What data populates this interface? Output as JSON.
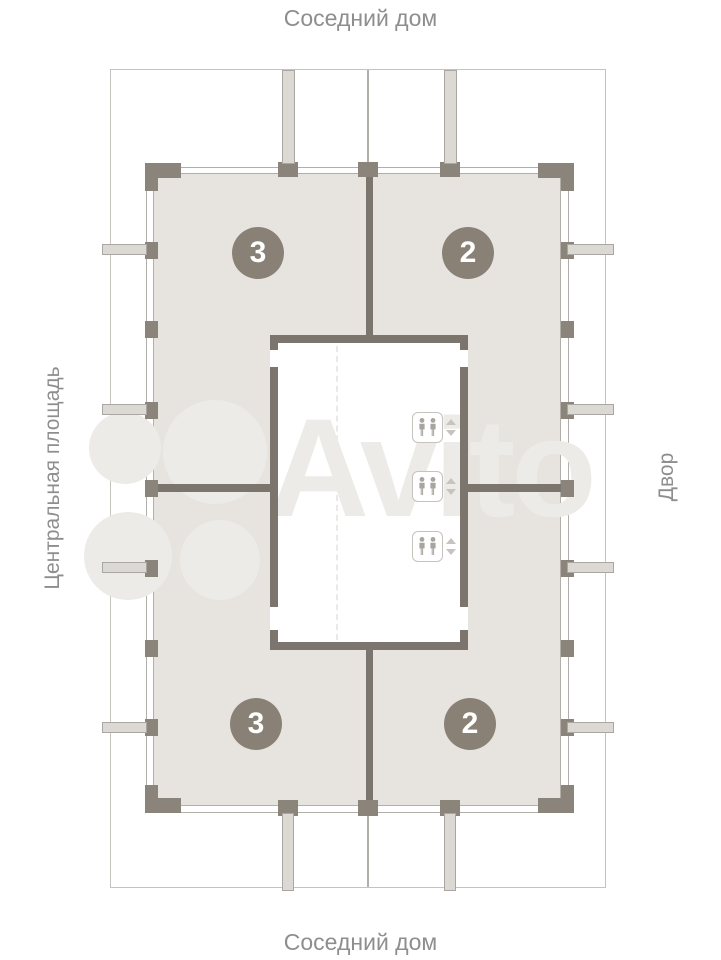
{
  "labels": {
    "top": "Соседний дом",
    "bottom": "Соседний дом",
    "left": "Центральная площадь",
    "right": "Двор"
  },
  "units": [
    {
      "number": "3",
      "position": "top-left"
    },
    {
      "number": "2",
      "position": "top-right"
    },
    {
      "number": "3",
      "position": "bottom-left"
    },
    {
      "number": "2",
      "position": "bottom-right"
    }
  ],
  "elevators": {
    "count": 3,
    "cabin_icon": "two-passengers",
    "call_buttons": [
      "up",
      "down"
    ]
  },
  "watermark": {
    "text": "Avito"
  },
  "colors": {
    "background": "#ffffff",
    "apartment_fill": "#e7e4e0",
    "wall_dark": "#7b756d",
    "pillar": "#8b847b",
    "thin_line": "#b2afaa",
    "boundary_line": "#c6c3be",
    "stub_fill": "#dcd9d4",
    "stub_border": "#aaa7a2",
    "unit_badge": "#8a8176",
    "unit_badge_text": "#ffffff",
    "label_text": "#8e8e8e",
    "watermark_color": "#edebe7",
    "elevator_border": "#c6c3be",
    "person_icon": "#a8a49e",
    "call_button": "#c7c4bf"
  }
}
